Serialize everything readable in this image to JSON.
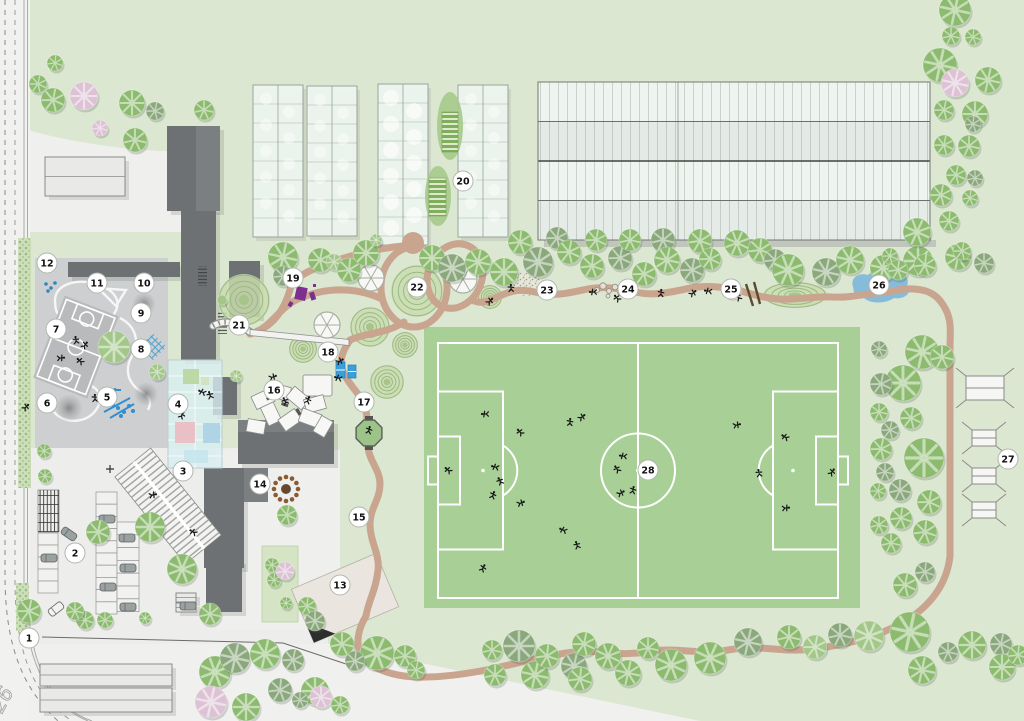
{
  "map": {
    "width": 1024,
    "height": 721,
    "kind": "campus-site-plan"
  },
  "road": {
    "label": "26"
  },
  "colors": {
    "bg": "#dce7d1",
    "pavement": "#f0f0ee",
    "parking": "#ececea",
    "playground": "#cdcfd0",
    "court": "#b8babb",
    "building_dark": "#6e7173",
    "building_mid": "#7c7f81",
    "building_light": "#e9e9e7",
    "glass": "#d8eef2",
    "greenhouse": "#edf5f0",
    "field_green": "#a7cf96",
    "line_white": "#ffffff",
    "path_brown": "#c9a58f",
    "tree_green": "#8cbb6f",
    "tree_dark": "#8aa87c",
    "tree_light": "#a3c789",
    "tree_pink": "#dcc2d4",
    "pond_blue": "#7fb7da",
    "accent_blue": "#2f8fd0",
    "accent_purple": "#7c2f8e",
    "marker_fill": "#ffffff",
    "marker_stroke": "#b0b6ae",
    "marker_text": "#111111"
  },
  "legend": {
    "marker": "numbered-location-marker",
    "tree": "tree-canopy-icon",
    "person": "person-figure-icon",
    "pond": "pond",
    "path": "walking-path",
    "field": "soccer-field"
  },
  "markers": [
    {
      "n": "1",
      "x": 29,
      "y": 638
    },
    {
      "n": "2",
      "x": 75,
      "y": 553
    },
    {
      "n": "3",
      "x": 183,
      "y": 471
    },
    {
      "n": "4",
      "x": 178,
      "y": 404
    },
    {
      "n": "5",
      "x": 107,
      "y": 397
    },
    {
      "n": "6",
      "x": 47,
      "y": 403
    },
    {
      "n": "7",
      "x": 56,
      "y": 329
    },
    {
      "n": "8",
      "x": 141,
      "y": 349
    },
    {
      "n": "9",
      "x": 141,
      "y": 313
    },
    {
      "n": "10",
      "x": 144,
      "y": 283
    },
    {
      "n": "11",
      "x": 97,
      "y": 283
    },
    {
      "n": "12",
      "x": 47,
      "y": 263
    },
    {
      "n": "13",
      "x": 340,
      "y": 585
    },
    {
      "n": "14",
      "x": 260,
      "y": 484
    },
    {
      "n": "15",
      "x": 359,
      "y": 517
    },
    {
      "n": "16",
      "x": 274,
      "y": 390
    },
    {
      "n": "17",
      "x": 364,
      "y": 402
    },
    {
      "n": "18",
      "x": 328,
      "y": 352
    },
    {
      "n": "19",
      "x": 293,
      "y": 278
    },
    {
      "n": "20",
      "x": 463,
      "y": 181
    },
    {
      "n": "21",
      "x": 239,
      "y": 325
    },
    {
      "n": "22",
      "x": 417,
      "y": 287
    },
    {
      "n": "23",
      "x": 547,
      "y": 290
    },
    {
      "n": "24",
      "x": 628,
      "y": 289
    },
    {
      "n": "25",
      "x": 731,
      "y": 289
    },
    {
      "n": "26",
      "x": 879,
      "y": 285
    },
    {
      "n": "27",
      "x": 1008,
      "y": 459
    },
    {
      "n": "28",
      "x": 648,
      "y": 470
    }
  ],
  "field": {
    "outer": [
      424,
      327,
      436,
      281
    ],
    "bounds": [
      438,
      343,
      400,
      255
    ],
    "mid_x": 638,
    "center": [
      638,
      470.5
    ],
    "circle_r": 37,
    "penalty_w": 65,
    "penalty_h": 158,
    "goalarea_w": 22,
    "goalarea_h": 68,
    "goal_w": 10,
    "goal_h": 28,
    "spot_dx": 45
  },
  "buildings": {
    "dark": [
      [
        167,
        126,
        53,
        85
      ],
      [
        181,
        208,
        35,
        152
      ],
      [
        68,
        262,
        112,
        15
      ],
      [
        229,
        261,
        31,
        56
      ],
      [
        213,
        377,
        24,
        38
      ],
      [
        238,
        420,
        96,
        44
      ],
      [
        204,
        468,
        40,
        100
      ],
      [
        206,
        560,
        36,
        52
      ]
    ],
    "mid": [
      [
        196,
        126,
        24,
        85
      ],
      [
        244,
        468,
        24,
        34
      ],
      [
        238,
        420,
        96,
        12
      ]
    ],
    "light": [
      [
        45,
        157,
        80,
        39
      ],
      [
        40,
        664,
        132,
        22
      ],
      [
        40,
        688,
        132,
        24
      ],
      [
        176,
        593,
        20,
        9
      ],
      [
        176,
        603,
        20,
        9
      ]
    ],
    "glass_atrium": [
      168,
      360,
      54,
      108
    ],
    "atrium_rooms": [
      {
        "x": 175,
        "y": 422,
        "w": 20,
        "h": 21,
        "c": "#e9b9c0"
      },
      {
        "x": 203,
        "y": 423,
        "w": 17,
        "h": 20,
        "c": "#a9d0e4"
      },
      {
        "x": 184,
        "y": 450,
        "w": 24,
        "h": 13,
        "c": "#c4e6ec"
      },
      {
        "x": 183,
        "y": 369,
        "w": 16,
        "h": 15,
        "c": "#b7d59b"
      },
      {
        "x": 201,
        "y": 377,
        "w": 8,
        "h": 8,
        "c": "#cfe3b8"
      }
    ]
  },
  "greenhouses": [
    [
      253,
      85,
      50,
      152
    ],
    [
      307,
      86,
      50,
      150
    ],
    [
      378,
      84,
      50,
      161
    ],
    [
      458,
      85,
      50,
      152
    ]
  ],
  "beds": {
    "ellipses": [
      [
        450,
        126,
        13,
        34
      ],
      [
        438,
        196,
        13,
        30
      ]
    ],
    "rects": [
      [
        442,
        112,
        16,
        40
      ],
      [
        429,
        178,
        17,
        38
      ]
    ]
  },
  "big_structure": {
    "x": 538,
    "y": 82,
    "w": 392,
    "h": 158,
    "bands": [
      "#eef5f0",
      "#e4eae6",
      "#eef5f0",
      "#e5ece7"
    ],
    "mid_x": 678
  },
  "mounds": [
    [
      244,
      300,
      26
    ],
    [
      417,
      291,
      26
    ],
    [
      370,
      327,
      20
    ],
    [
      303,
      349,
      14
    ],
    [
      387,
      382,
      17
    ],
    [
      405,
      345,
      13
    ],
    [
      490,
      297,
      12
    ],
    [
      795,
      295,
      32,
      13
    ]
  ],
  "pavilions": [
    [
      371,
      278,
      13
    ],
    [
      463,
      279,
      14
    ],
    [
      327,
      325,
      13
    ]
  ],
  "trees": [
    [
      55,
      63,
      8,
      "g"
    ],
    [
      38,
      84,
      9,
      "g"
    ],
    [
      53,
      100,
      12,
      "g"
    ],
    [
      84,
      96,
      14,
      "p"
    ],
    [
      100,
      128,
      8,
      "p"
    ],
    [
      132,
      103,
      13,
      "g"
    ],
    [
      155,
      111,
      9,
      "d"
    ],
    [
      204,
      110,
      10,
      "g"
    ],
    [
      135,
      140,
      12,
      "g"
    ],
    [
      283,
      257,
      15,
      "g"
    ],
    [
      283,
      276,
      10,
      "d"
    ],
    [
      320,
      260,
      12,
      "g"
    ],
    [
      334,
      262,
      8,
      "l"
    ],
    [
      349,
      270,
      12,
      "g"
    ],
    [
      366,
      253,
      13,
      "g"
    ],
    [
      376,
      240,
      6,
      "l"
    ],
    [
      236,
      376,
      6,
      "l"
    ],
    [
      222,
      300,
      5,
      "l"
    ],
    [
      432,
      258,
      13,
      "g"
    ],
    [
      452,
      268,
      14,
      "d"
    ],
    [
      478,
      262,
      13,
      "g"
    ],
    [
      504,
      272,
      14,
      "g"
    ],
    [
      520,
      242,
      12,
      "g"
    ],
    [
      538,
      262,
      15,
      "d"
    ],
    [
      557,
      238,
      11,
      "d"
    ],
    [
      569,
      252,
      12,
      "g"
    ],
    [
      592,
      266,
      12,
      "g"
    ],
    [
      596,
      240,
      11,
      "g"
    ],
    [
      620,
      258,
      12,
      "d"
    ],
    [
      630,
      240,
      11,
      "g"
    ],
    [
      644,
      274,
      12,
      "g"
    ],
    [
      663,
      240,
      12,
      "d"
    ],
    [
      667,
      260,
      13,
      "g"
    ],
    [
      692,
      270,
      12,
      "d"
    ],
    [
      700,
      241,
      12,
      "g"
    ],
    [
      710,
      259,
      11,
      "g"
    ],
    [
      737,
      243,
      13,
      "g"
    ],
    [
      760,
      250,
      12,
      "g"
    ],
    [
      775,
      260,
      11,
      "d"
    ],
    [
      788,
      270,
      16,
      "g"
    ],
    [
      826,
      272,
      14,
      "d"
    ],
    [
      850,
      260,
      14,
      "g"
    ],
    [
      883,
      268,
      13,
      "g"
    ],
    [
      918,
      261,
      15,
      "g"
    ],
    [
      958,
      257,
      13,
      "g"
    ],
    [
      984,
      263,
      10,
      "d"
    ],
    [
      955,
      10,
      16,
      "g"
    ],
    [
      951,
      36,
      9,
      "g"
    ],
    [
      973,
      37,
      8,
      "g"
    ],
    [
      940,
      65,
      17,
      "g"
    ],
    [
      955,
      83,
      14,
      "p"
    ],
    [
      988,
      80,
      13,
      "g"
    ],
    [
      944,
      110,
      10,
      "g"
    ],
    [
      975,
      114,
      13,
      "g"
    ],
    [
      973,
      124,
      8,
      "d"
    ],
    [
      944,
      145,
      10,
      "g"
    ],
    [
      969,
      146,
      11,
      "g"
    ],
    [
      956,
      175,
      10,
      "g"
    ],
    [
      975,
      178,
      8,
      "d"
    ],
    [
      941,
      195,
      11,
      "g"
    ],
    [
      970,
      198,
      8,
      "g"
    ],
    [
      949,
      221,
      10,
      "g"
    ],
    [
      917,
      232,
      14,
      "g"
    ],
    [
      962,
      251,
      9,
      "g"
    ],
    [
      925,
      265,
      11,
      "g"
    ],
    [
      890,
      256,
      8,
      "g"
    ],
    [
      898,
      270,
      10,
      "g"
    ],
    [
      922,
      352,
      17,
      "g"
    ],
    [
      879,
      349,
      8,
      "d"
    ],
    [
      942,
      357,
      12,
      "g"
    ],
    [
      903,
      383,
      18,
      "g"
    ],
    [
      881,
      384,
      11,
      "d"
    ],
    [
      911,
      418,
      11,
      "g"
    ],
    [
      879,
      412,
      9,
      "g"
    ],
    [
      890,
      430,
      9,
      "d"
    ],
    [
      924,
      458,
      20,
      "g"
    ],
    [
      881,
      449,
      11,
      "g"
    ],
    [
      885,
      472,
      9,
      "d"
    ],
    [
      878,
      491,
      8,
      "g"
    ],
    [
      900,
      490,
      11,
      "d"
    ],
    [
      929,
      502,
      12,
      "g"
    ],
    [
      901,
      518,
      11,
      "g"
    ],
    [
      925,
      532,
      12,
      "g"
    ],
    [
      879,
      525,
      9,
      "g"
    ],
    [
      891,
      543,
      10,
      "g"
    ],
    [
      905,
      585,
      12,
      "g"
    ],
    [
      925,
      572,
      10,
      "d"
    ],
    [
      29,
      611,
      12,
      "g"
    ],
    [
      85,
      620,
      9,
      "g"
    ],
    [
      105,
      620,
      8,
      "g"
    ],
    [
      145,
      618,
      6,
      "g"
    ],
    [
      215,
      672,
      16,
      "g"
    ],
    [
      235,
      658,
      15,
      "d"
    ],
    [
      265,
      654,
      15,
      "g"
    ],
    [
      293,
      660,
      11,
      "d"
    ],
    [
      315,
      691,
      14,
      "g"
    ],
    [
      280,
      690,
      12,
      "d"
    ],
    [
      211,
      702,
      16,
      "p"
    ],
    [
      246,
      707,
      14,
      "g"
    ],
    [
      321,
      697,
      11,
      "p"
    ],
    [
      340,
      705,
      9,
      "g"
    ],
    [
      300,
      700,
      8,
      "d"
    ],
    [
      342,
      644,
      12,
      "g"
    ],
    [
      377,
      653,
      17,
      "g"
    ],
    [
      355,
      661,
      10,
      "d"
    ],
    [
      405,
      656,
      11,
      "g"
    ],
    [
      416,
      670,
      9,
      "g"
    ],
    [
      492,
      650,
      10,
      "g"
    ],
    [
      519,
      646,
      16,
      "d"
    ],
    [
      495,
      675,
      11,
      "g"
    ],
    [
      535,
      675,
      14,
      "g"
    ],
    [
      547,
      656,
      12,
      "g"
    ],
    [
      574,
      666,
      13,
      "d"
    ],
    [
      584,
      644,
      12,
      "g"
    ],
    [
      608,
      656,
      13,
      "g"
    ],
    [
      580,
      679,
      12,
      "g"
    ],
    [
      628,
      673,
      13,
      "g"
    ],
    [
      648,
      648,
      11,
      "g"
    ],
    [
      671,
      665,
      16,
      "g"
    ],
    [
      710,
      658,
      16,
      "g"
    ],
    [
      748,
      642,
      14,
      "d"
    ],
    [
      789,
      637,
      12,
      "g"
    ],
    [
      815,
      647,
      12,
      "l"
    ],
    [
      840,
      635,
      12,
      "d"
    ],
    [
      869,
      636,
      15,
      "l"
    ],
    [
      910,
      632,
      20,
      "g"
    ],
    [
      922,
      670,
      14,
      "g"
    ],
    [
      948,
      652,
      10,
      "d"
    ],
    [
      972,
      645,
      14,
      "g"
    ],
    [
      1001,
      644,
      11,
      "d"
    ],
    [
      1002,
      667,
      13,
      "g"
    ],
    [
      1018,
      655,
      10,
      "g"
    ],
    [
      44,
      451,
      7,
      "g"
    ],
    [
      45,
      476,
      7,
      "g"
    ],
    [
      98,
      532,
      12,
      "g"
    ],
    [
      150,
      527,
      15,
      "g"
    ],
    [
      182,
      569,
      15,
      "g"
    ],
    [
      210,
      614,
      11,
      "g"
    ],
    [
      75,
      611,
      9,
      "g"
    ],
    [
      114,
      347,
      16,
      "l"
    ],
    [
      157,
      372,
      8,
      "l"
    ],
    [
      287,
      515,
      10,
      "g"
    ],
    [
      272,
      565,
      7,
      "g"
    ],
    [
      274,
      580,
      7,
      "g"
    ],
    [
      285,
      571,
      9,
      "p"
    ],
    [
      286,
      603,
      6,
      "g"
    ],
    [
      307,
      606,
      9,
      "g"
    ],
    [
      315,
      621,
      10,
      "d"
    ]
  ],
  "people": [
    [
      485,
      414
    ],
    [
      520,
      432
    ],
    [
      570,
      422
    ],
    [
      582,
      417
    ],
    [
      623,
      456
    ],
    [
      617,
      469
    ],
    [
      633,
      490
    ],
    [
      621,
      493
    ],
    [
      495,
      467
    ],
    [
      500,
      481
    ],
    [
      493,
      495
    ],
    [
      521,
      503
    ],
    [
      563,
      530
    ],
    [
      577,
      545
    ],
    [
      483,
      568
    ],
    [
      737,
      425
    ],
    [
      785,
      437
    ],
    [
      759,
      473
    ],
    [
      832,
      472
    ],
    [
      786,
      508
    ],
    [
      448,
      470
    ],
    [
      511,
      288
    ],
    [
      490,
      301
    ],
    [
      593,
      292
    ],
    [
      617,
      298
    ],
    [
      661,
      293
    ],
    [
      693,
      293
    ],
    [
      708,
      291
    ],
    [
      738,
      297
    ],
    [
      369,
      430
    ],
    [
      340,
      361
    ],
    [
      338,
      378
    ],
    [
      285,
      401
    ],
    [
      308,
      400
    ],
    [
      273,
      377
    ],
    [
      202,
      392
    ],
    [
      210,
      395
    ],
    [
      182,
      415
    ],
    [
      153,
      495
    ],
    [
      193,
      532
    ],
    [
      76,
      340
    ],
    [
      85,
      345
    ],
    [
      61,
      358
    ],
    [
      80,
      361
    ],
    [
      95,
      398
    ],
    [
      26,
      407
    ]
  ],
  "cars": [
    [
      107,
      519,
      0,
      "g"
    ],
    [
      127,
      538,
      0,
      "g"
    ],
    [
      128,
      568,
      0,
      "g"
    ],
    [
      108,
      587,
      0,
      "g"
    ],
    [
      128,
      607,
      0,
      "g"
    ],
    [
      49,
      558,
      0,
      "g"
    ],
    [
      69,
      534,
      35,
      "g"
    ],
    [
      56,
      609,
      -38,
      "w"
    ],
    [
      188,
      606,
      0,
      "g"
    ]
  ],
  "parking_rows": [
    {
      "x": 96,
      "y": 492,
      "w": 21,
      "h": 12.2,
      "n": 10
    },
    {
      "x": 117,
      "y": 522,
      "w": 22,
      "h": 12.8,
      "n": 7
    },
    {
      "x": 38,
      "y": 533,
      "w": 20,
      "h": 12,
      "n": 5
    }
  ],
  "bike_rack": [
    38,
    490,
    21,
    42
  ],
  "stations": [
    [
      966,
      376,
      38,
      24
    ],
    [
      972,
      430,
      24,
      16
    ],
    [
      972,
      468,
      24,
      16
    ],
    [
      972,
      502,
      24,
      16
    ]
  ],
  "boulders": [
    [
      597,
      290,
      2.6
    ],
    [
      603,
      286,
      3.2
    ],
    [
      609,
      291,
      2.4
    ],
    [
      615,
      287,
      2.8
    ],
    [
      620,
      293,
      2.2
    ],
    [
      608,
      296,
      2
    ]
  ],
  "canopies": [
    [
      253,
      392,
      20,
      14,
      -25
    ],
    [
      270,
      385,
      20,
      14,
      15
    ],
    [
      288,
      391,
      20,
      14,
      40
    ],
    [
      305,
      397,
      20,
      14,
      -15
    ],
    [
      261,
      407,
      20,
      14,
      65
    ],
    [
      280,
      413,
      20,
      14,
      -35
    ],
    [
      300,
      411,
      20,
      14,
      20
    ],
    [
      314,
      420,
      18,
      13,
      -60
    ],
    [
      247,
      420,
      18,
      13,
      10
    ]
  ],
  "benches": [
    [
      282,
      402,
      7,
      3,
      20
    ],
    [
      266,
      398,
      7,
      3,
      -30
    ],
    [
      298,
      408,
      7,
      3,
      60
    ]
  ],
  "blue_tables": [
    [
      336,
      362,
      9,
      16
    ],
    [
      348,
      365,
      8,
      13
    ]
  ],
  "stage": [
    303,
    375,
    29,
    21
  ],
  "purple_sculptures": [
    [
      297,
      286,
      11,
      13,
      12
    ],
    [
      309,
      293,
      5,
      8,
      -18
    ],
    [
      290,
      301,
      4,
      5,
      30
    ],
    [
      313,
      284,
      3,
      3,
      0
    ]
  ],
  "craters": [
    [
      144,
      304,
      12
    ],
    [
      69,
      408,
      14
    ],
    [
      146,
      394,
      12
    ]
  ],
  "fire_pit": {
    "x": 286,
    "y": 489,
    "ring_r": 12,
    "dots": 12
  },
  "blue_dots_12": [
    [
      46,
      284
    ],
    [
      51,
      288
    ],
    [
      55,
      283
    ],
    [
      48,
      291
    ]
  ],
  "blue_play_dots": [
    [
      118,
      408
    ],
    [
      124,
      412
    ],
    [
      129,
      406
    ],
    [
      121,
      416
    ],
    [
      113,
      405
    ],
    [
      133,
      411
    ]
  ]
}
